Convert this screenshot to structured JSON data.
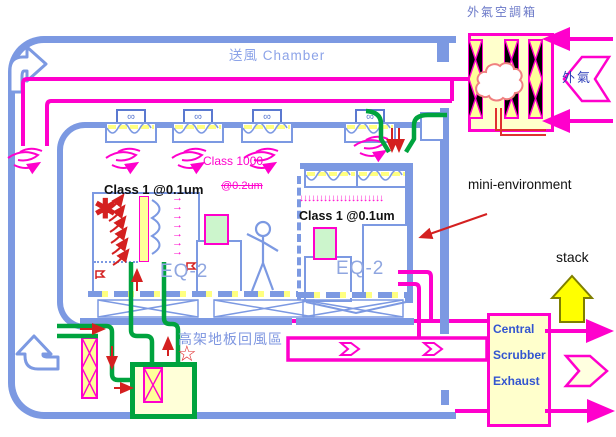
{
  "diagram": {
    "labels": {
      "makeup_air_unit": "外氣空調箱",
      "supply_chamber": "送風 Chamber",
      "class_1000": "Class 1000",
      "class_02um_strikethrough": "@0.2um",
      "class_1_left": "Class 1 @0.1um",
      "class_1_right": "Class 1 @0.1um",
      "mini_environment": "mini-environment",
      "eq2_left": "EQ-2",
      "eq2_right": "EQ-2",
      "raised_floor_return_area": "高架地板回風區",
      "outside_air": "外氣",
      "stack": "stack"
    },
    "scrubber": {
      "line1": "Central",
      "line2": "Scrubber",
      "line3": "Exhaust"
    },
    "icons": {
      "fan_unit": "∞",
      "contamination_asterisk": "✱",
      "star_marker": "☆",
      "downflow_arrows": "↓↓↓↓↓↓↓↓↓↓↓↓↓↓↓↓↓↓↓↓↓",
      "sideflow_arrows": "→\n→\n→\n→\n→\n→\n→"
    },
    "colors": {
      "duct_blue": "#7C99E2",
      "magenta": "#FF00CC",
      "green": "#00A33E",
      "red": "#D42020",
      "cream": "#FFFFCC",
      "stack_yellow": "#FFFF00",
      "label_blue": "#7E96E0",
      "scrubber_text_blue": "#3355D0",
      "load_port_green": "#CCF5CC"
    }
  }
}
